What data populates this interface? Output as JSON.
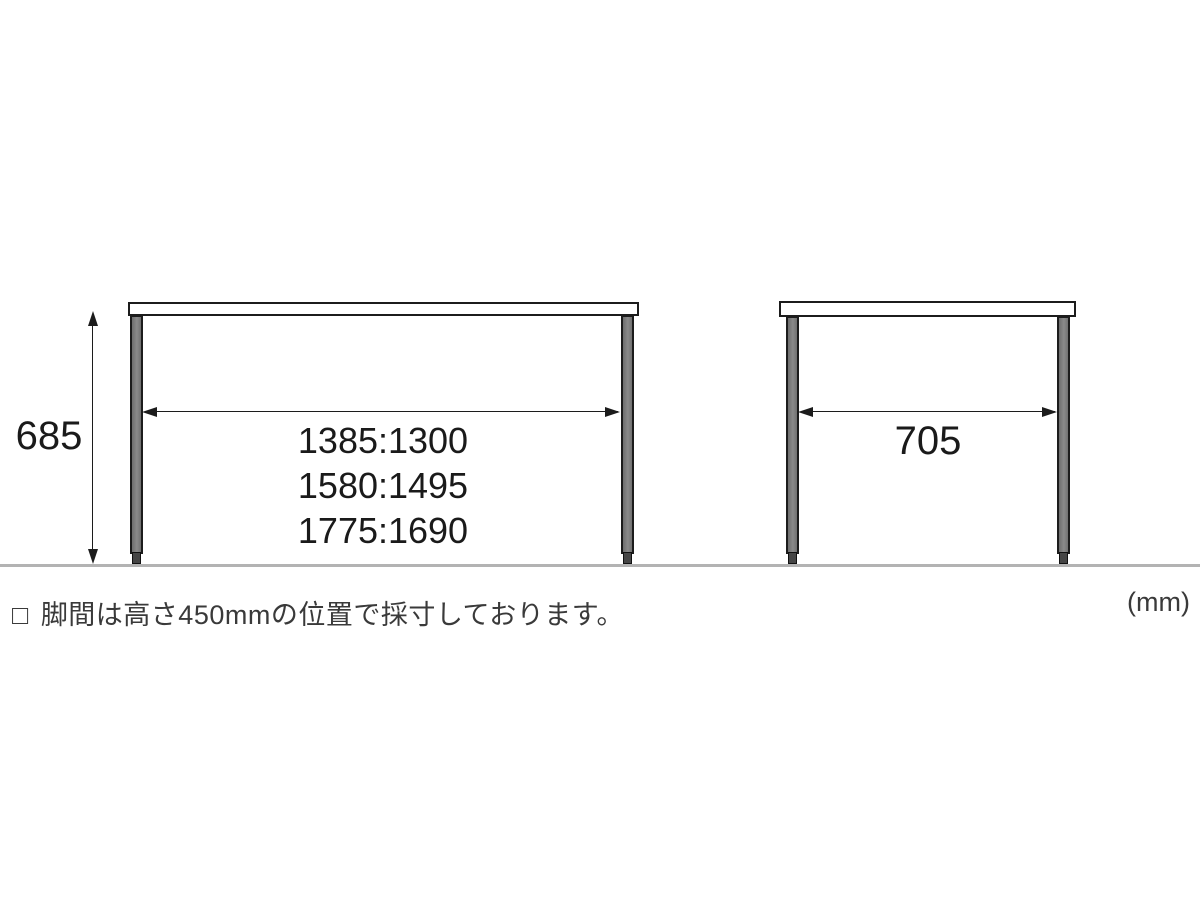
{
  "colors": {
    "outline": "#1c1c1c",
    "leg_fill": "#7b7b7b",
    "floor": "#b3b3b3",
    "text": "#1a1a1a",
    "note_text": "#3a3a3a"
  },
  "front_view": {
    "height_label": "685",
    "leg_span_labels": [
      "1385:1300",
      "1580:1495",
      "1775:1690"
    ]
  },
  "side_view": {
    "leg_span_label": "705"
  },
  "footer": {
    "note_marker": "□",
    "note_text": "脚間は高さ450mmの位置で採寸しております。",
    "unit_label": "(mm)"
  }
}
